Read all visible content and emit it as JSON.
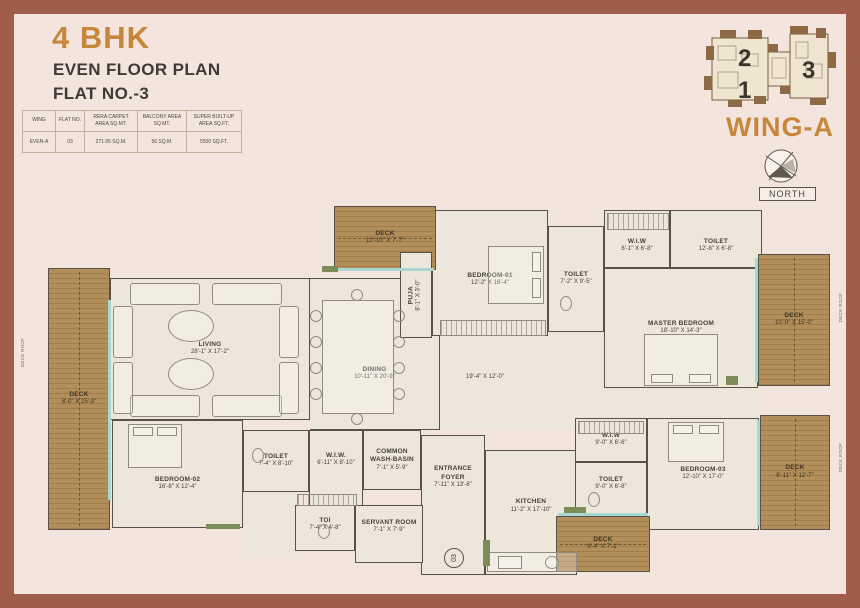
{
  "header": {
    "title": "4 BHK",
    "line1": "EVEN FLOOR PLAN",
    "line2": "FLAT NO.-3"
  },
  "info_table": {
    "col_headers": [
      "WING",
      "FLAT NO.",
      "RERA CARPET AREA SQ.MT.",
      "BALCONY AREA SQ.MT.",
      "SUPER BUILT-UP AREA SQ.FT."
    ],
    "row": [
      "EVEN-A",
      "03",
      "271.95 SQ.M.",
      "56 SQ.M.",
      "5500 SQ.FT."
    ]
  },
  "key_plan": {
    "units": [
      "2",
      "1",
      "3"
    ],
    "wing_label": "WING-A",
    "north_label": "NORTH"
  },
  "plan": {
    "flat_marker": "03",
    "deck_roof_label": "DECK ROOF",
    "passage_dims": "19'-4\" X 12'-0\"",
    "rooms": [
      {
        "name": "LIVING",
        "dims": "28'-1\" X 17'-2\""
      },
      {
        "name": "DINING",
        "dims": "10'-11\" X 20'-9\""
      },
      {
        "name": "PUJA",
        "dims": "8'-1\" X 3'-0\""
      },
      {
        "name": "BEDROOM-01",
        "dims": "12'-2\" X 16'-4\""
      },
      {
        "name": "TOILET",
        "dims": "7'-2\" X 9'-5\""
      },
      {
        "name": "W.I.W",
        "dims": "6'-1\" X 6'-8\""
      },
      {
        "name": "TOILET",
        "dims": "12'-8\" X 6'-8\""
      },
      {
        "name": "MASTER BEDROOM",
        "dims": "18'-10\" X 14'-3\""
      },
      {
        "name": "DECK",
        "dims": "12'-10\" X 7'-7\""
      },
      {
        "name": "DECK",
        "dims": "10'-0\" X 15'-0\""
      },
      {
        "name": "DECK",
        "dims": "8'-0\" X 25'-3\""
      },
      {
        "name": "BEDROOM-02",
        "dims": "16'-8\" X 12'-4\""
      },
      {
        "name": "TOILET",
        "dims": "7'-4\" X 8'-10\""
      },
      {
        "name": "W.I.W.",
        "dims": "6'-11\" X 8'-10\""
      },
      {
        "name": "COMMON WASH-BASIN",
        "dims": "7'-1\" X 5'-9\""
      },
      {
        "name": "ENTRANCE FOYER",
        "dims": "7'-11\" X 13'-8\""
      },
      {
        "name": "TOI",
        "dims": "7'-4\" X 4'-8\""
      },
      {
        "name": "SERVANT ROOM",
        "dims": "7'-1\" X 7'-9\""
      },
      {
        "name": "KITCHEN",
        "dims": "11'-2\" X 17'-10\""
      },
      {
        "name": "W.I.W",
        "dims": "9'-0\" X 6'-6\""
      },
      {
        "name": "TOILET",
        "dims": "9'-0\" X 6'-8\""
      },
      {
        "name": "BEDROOM-03",
        "dims": "12'-10\" X 17'-0\""
      },
      {
        "name": "DECK",
        "dims": "6'-11\" X 12'-7\""
      },
      {
        "name": "DECK",
        "dims": "9'-4\" X 7'-1\""
      }
    ]
  },
  "colors": {
    "accent": "#c6873b",
    "frame": "#a05e4a",
    "background": "#f3e4dd",
    "floor": "#ece7da",
    "deck": "#b28e5b",
    "wall": "#56524a"
  }
}
